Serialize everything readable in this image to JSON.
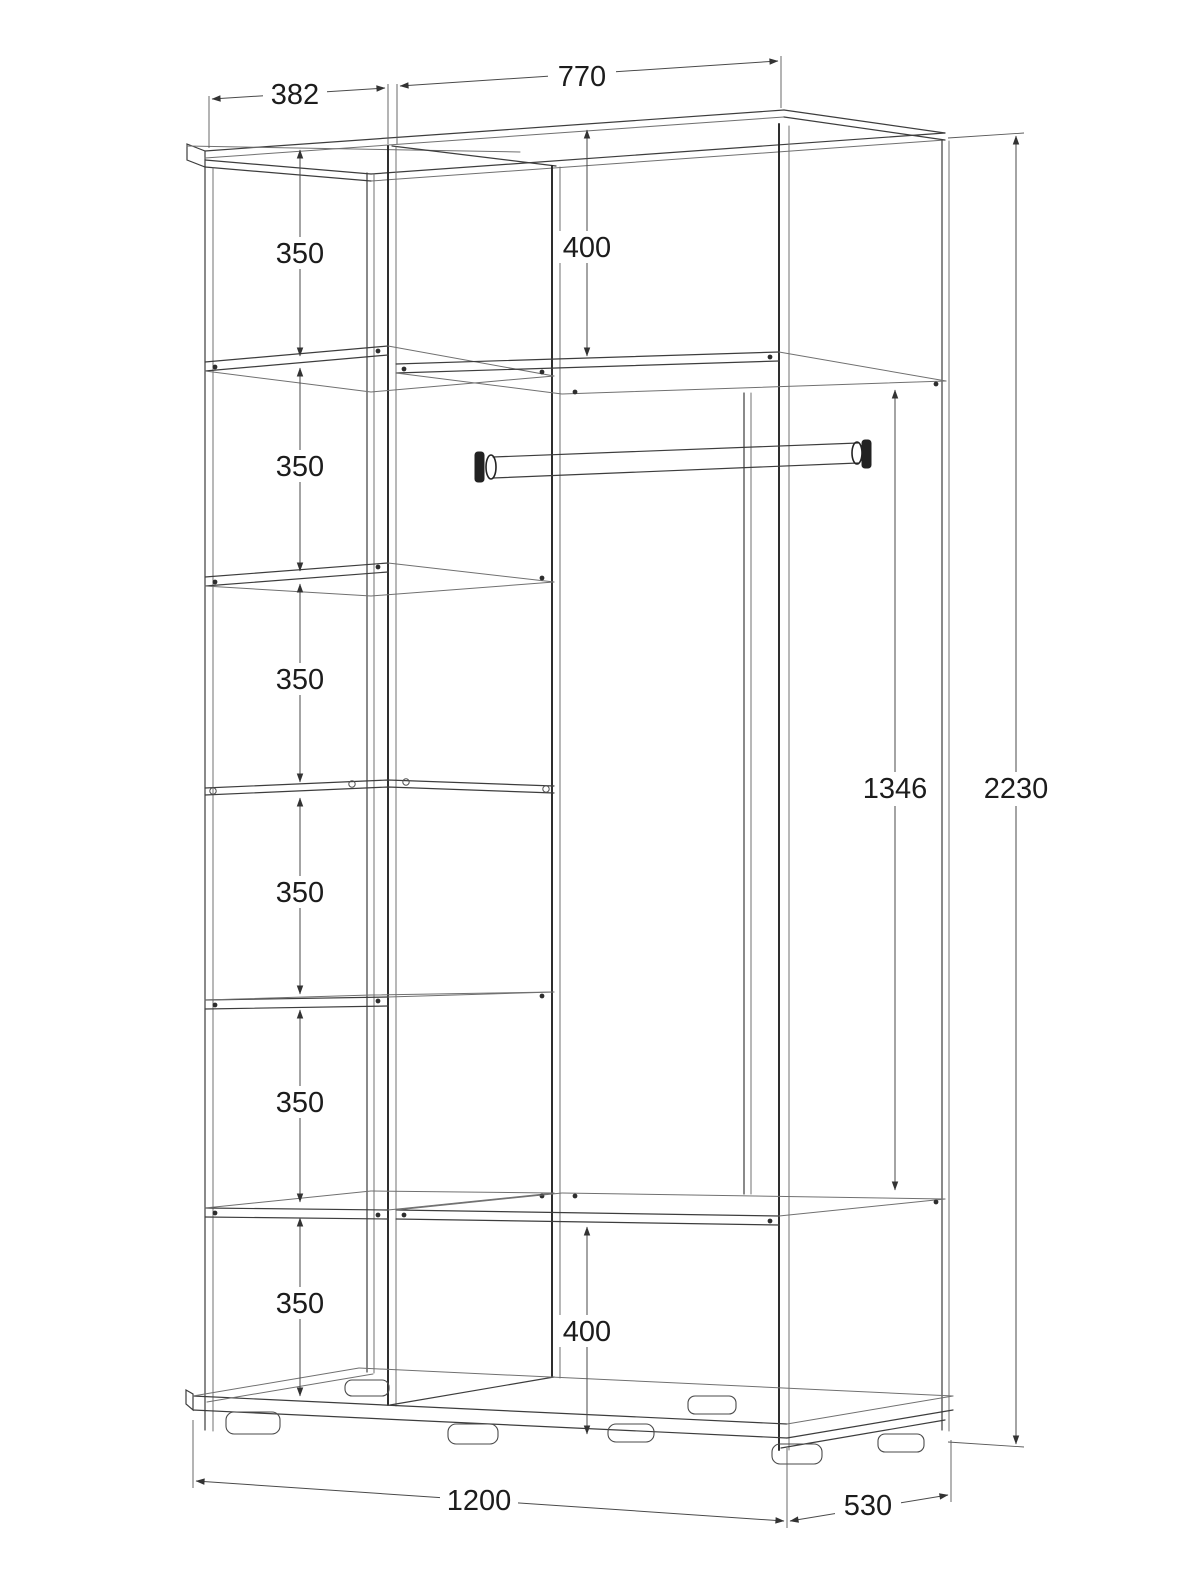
{
  "drawing": {
    "type": "wardrobe-technical-drawing",
    "units": "mm",
    "dims": {
      "left_section_width": "382",
      "right_section_width": "770",
      "shelf_spacings": [
        "350",
        "350",
        "350",
        "350",
        "350",
        "350"
      ],
      "top_shelf_offset": "400",
      "rod_section_height": "1346",
      "overall_height": "2230",
      "bottom_shelf_offset": "400",
      "overall_width": "1200",
      "overall_depth": "530"
    }
  }
}
